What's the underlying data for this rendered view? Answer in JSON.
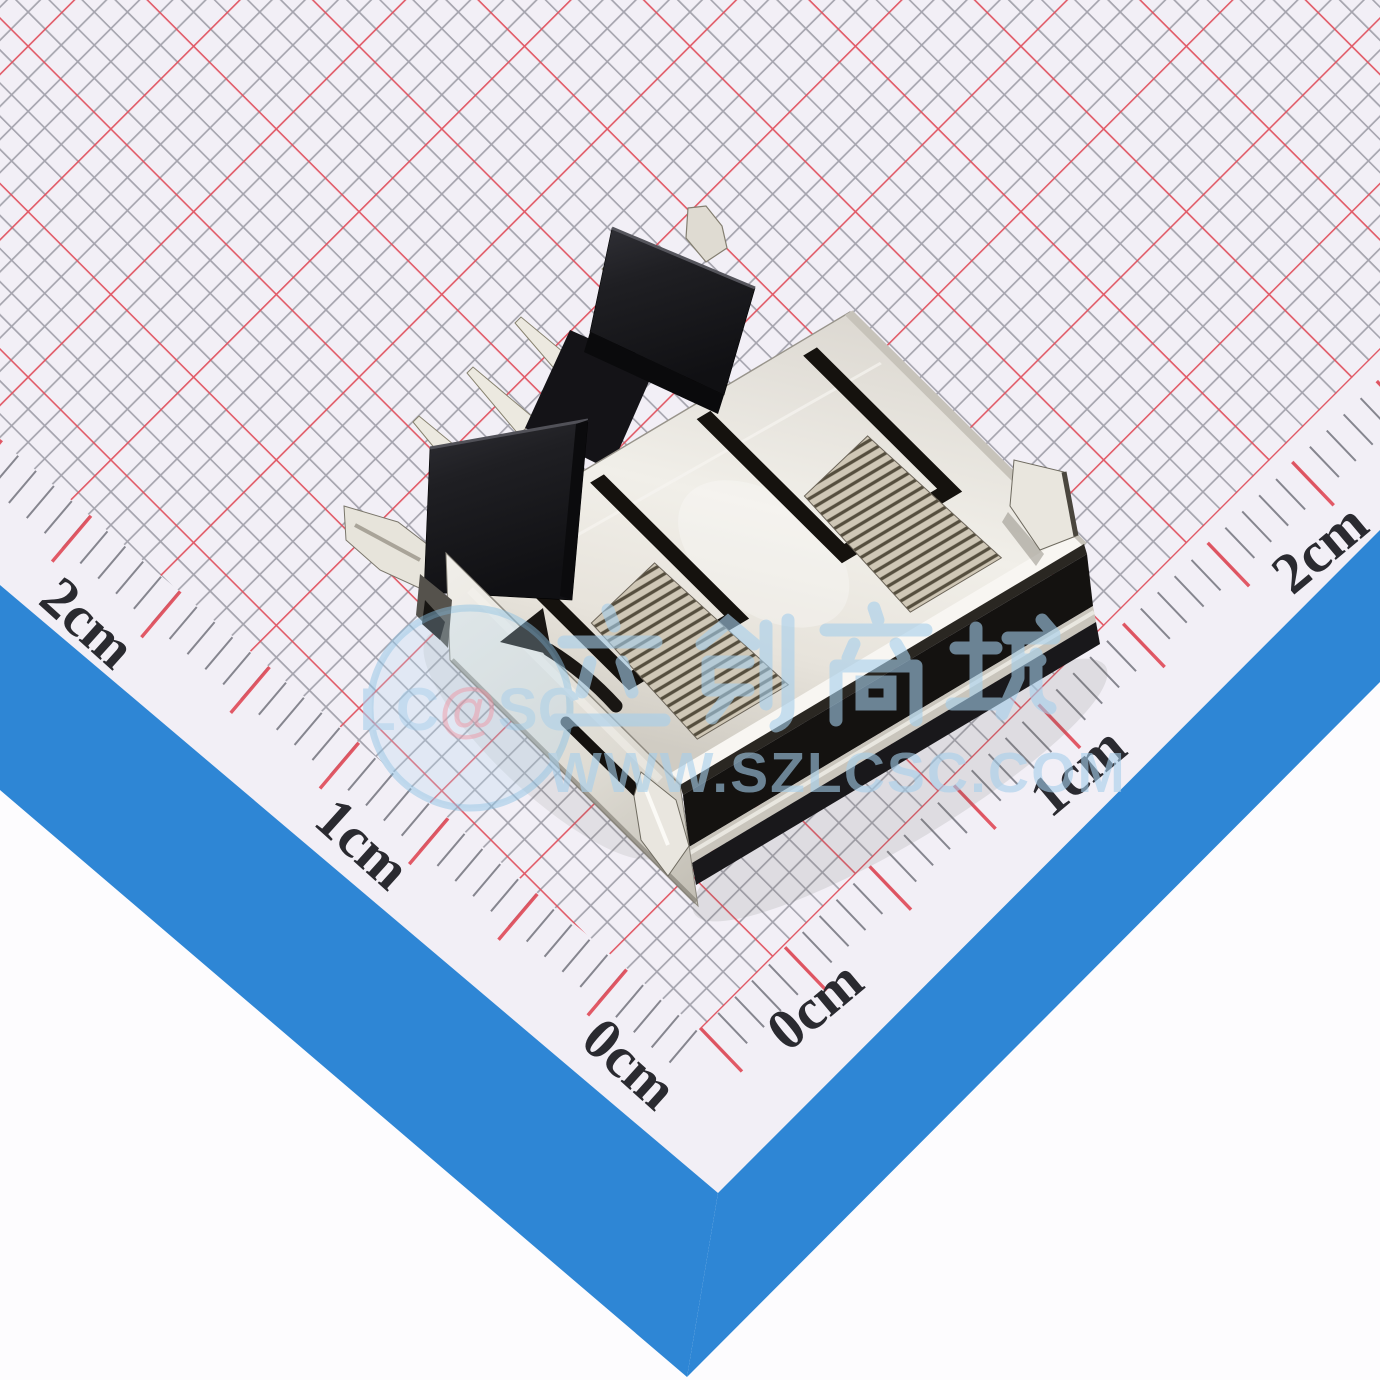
{
  "photo": {
    "subject": "USB Type-A female connector (through-hole) lying on millimeter grid paper"
  },
  "ruler": {
    "unit": "cm",
    "left_labels": [
      "2cm",
      "1cm",
      "0cm"
    ],
    "right_labels": [
      "0cm",
      "1cm",
      "2cm"
    ]
  },
  "watermark": {
    "logo_prefix": "LC",
    "logo_at": "@",
    "logo_suffix": "SC",
    "brand_cn": "立创商城",
    "url": "WWW.SZLCSC.COM"
  },
  "colors": {
    "paper": "#f2eff6",
    "grid_minor": "#8b8b95",
    "grid_major": "#e1525f",
    "border_stripe": "#2e86d5",
    "outside_background": "#fdfcfe",
    "ruler_text": "#2a2a30",
    "watermark_blue": "#a6cfec",
    "watermark_pink": "#e2a3b3",
    "connector_shell": "#e9e6df",
    "connector_plastic": "#1e1e22"
  }
}
